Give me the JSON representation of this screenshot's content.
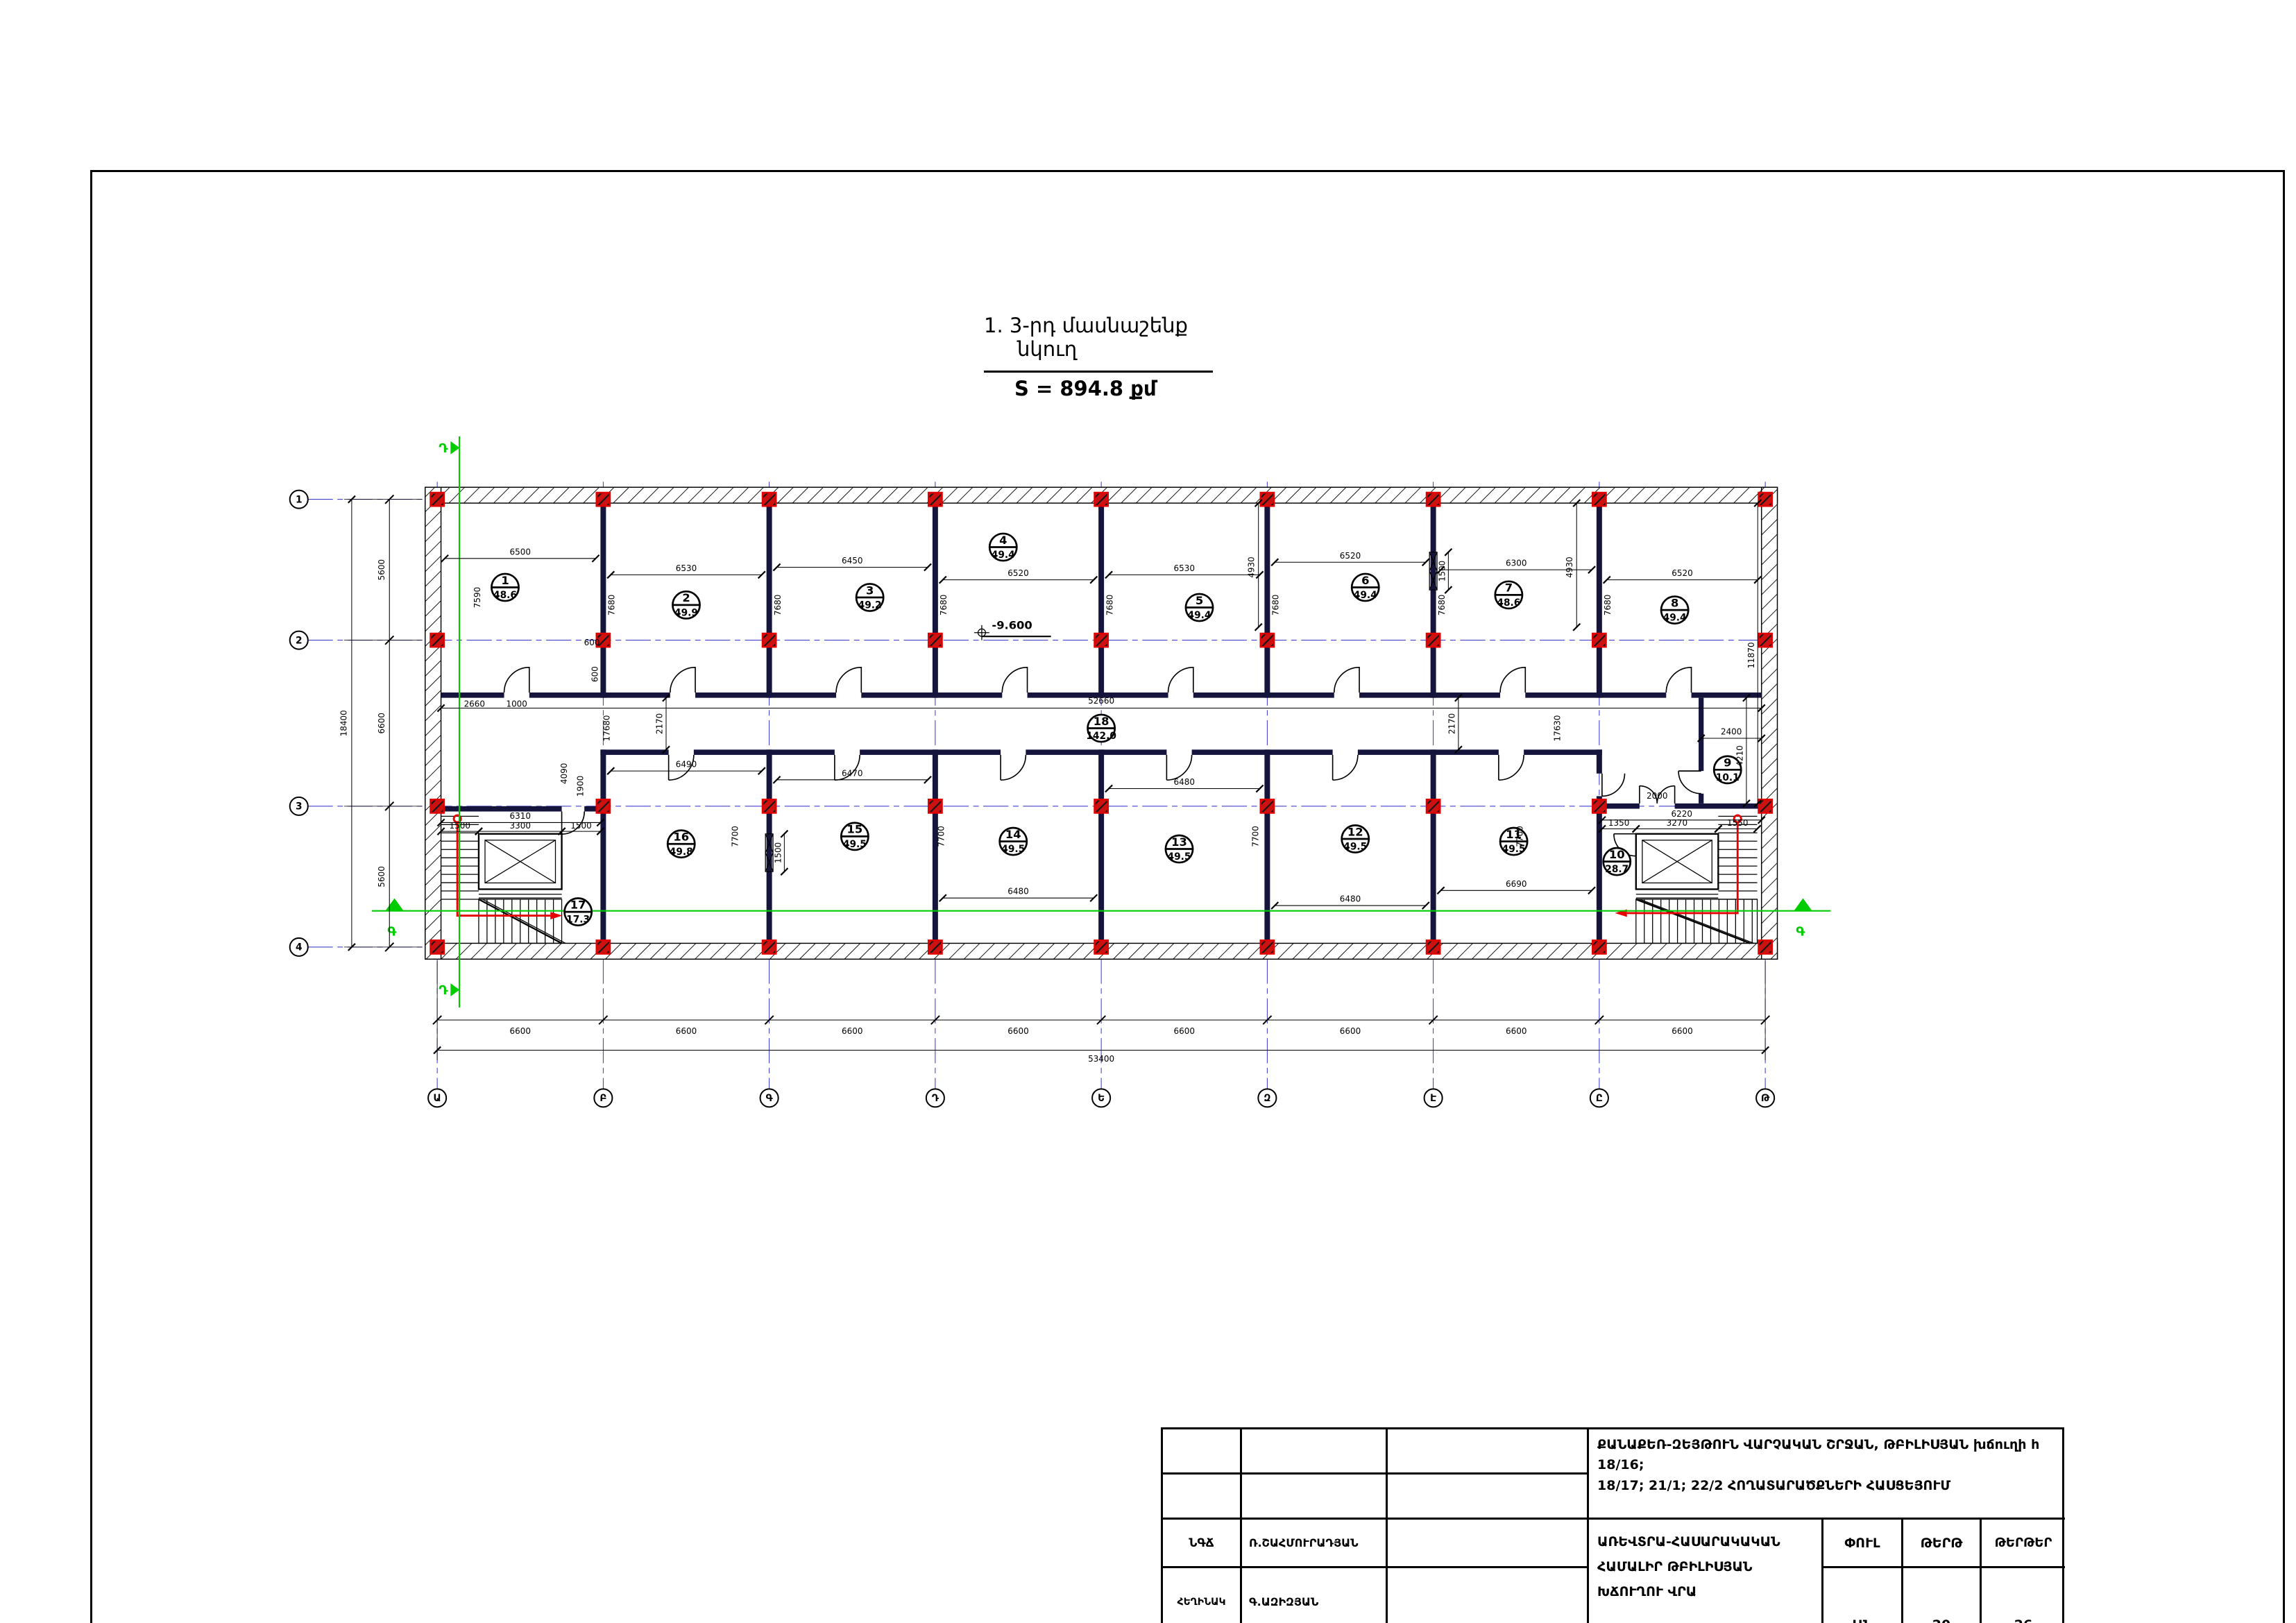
{
  "page": {
    "title_line1": "1. 3-րդ մասնաշենք",
    "title_line2": "նկուղ",
    "area_total": "S = 894.8 քմ"
  },
  "plan": {
    "level_mark": "-9.600",
    "axes_cols": [
      "Ա",
      "Բ",
      "Գ",
      "Դ",
      "Ե",
      "Զ",
      "Է",
      "Ը",
      "Թ"
    ],
    "axes_rows": [
      "1",
      "2",
      "3",
      "4"
    ],
    "bottom_dims": {
      "bays": [
        "6600",
        "6600",
        "6600",
        "6600",
        "6600",
        "6600",
        "6600",
        "6600"
      ],
      "total": "53400"
    },
    "left_dims": {
      "segments": [
        "5600",
        "6600",
        "5600"
      ],
      "total": "18400"
    },
    "rooms_top": [
      {
        "no": "1",
        "area": "48.6",
        "w": "6500",
        "h": "7590"
      },
      {
        "no": "2",
        "area": "49.9",
        "w": "6530",
        "h": "7680"
      },
      {
        "no": "3",
        "area": "49.2",
        "w": "6450",
        "h": "7680"
      },
      {
        "no": "4",
        "area": "49.4",
        "w": "6520",
        "h": "7680"
      },
      {
        "no": "5",
        "area": "49.4",
        "w": "6530",
        "h": "7680"
      },
      {
        "no": "6",
        "area": "49.4",
        "w": "6520",
        "h": "7680"
      },
      {
        "no": "7",
        "area": "48.6",
        "w": "6300",
        "h": "7680"
      },
      {
        "no": "8",
        "area": "49.4",
        "w": "6520",
        "h": "7680"
      }
    ],
    "rooms_bottom": [
      {
        "no": "16",
        "area": "49.8",
        "w": "6490",
        "h": "7700"
      },
      {
        "no": "15",
        "area": "49.5",
        "w": "6470",
        "h": "7700"
      },
      {
        "no": "14",
        "area": "49.5",
        "w": "6480",
        "h": "7700"
      },
      {
        "no": "13",
        "area": "49.5",
        "w": "6480",
        "h": "7700"
      },
      {
        "no": "12",
        "area": "49.5",
        "w": "6480",
        "h": "7700"
      },
      {
        "no": "11",
        "area": "49.5",
        "w": "6690",
        "h": "7700"
      }
    ],
    "corridor": {
      "no": "18",
      "area": "142.0",
      "length": "52660",
      "h_left": "17680",
      "w_left": "2170",
      "h_right": "17630",
      "w_right": "2170"
    },
    "room9": {
      "no": "9",
      "area": "10.1",
      "w": "2400",
      "h": "4210"
    },
    "stair_left": {
      "no": "17",
      "area": "17.3",
      "total": "6310",
      "p1": "1500",
      "p2": "3300",
      "p3": "1500"
    },
    "stair_right": {
      "no": "10",
      "area": "28.7",
      "total": "6220",
      "p1": "1350",
      "p2": "3270",
      "p3": "1550"
    },
    "dims": {
      "right": "11870",
      "n4930": "4930",
      "n4090": "4090",
      "n1900": "1900",
      "n1500": "1500",
      "n2660": "2660",
      "n1000": "1000",
      "n600": "600",
      "n7700": "7700",
      "n2000": "2000"
    },
    "sections": {
      "h": "Գ",
      "v": "Դ"
    }
  },
  "titleblock": {
    "project_line1": "ՔԱՆԱՔԵՌ-ԶԵՅԹՈՒՆ ՎԱՐՉԱԿԱՆ ՇՐՋԱՆ, ԹԲԻԼԻՍՅԱՆ խճուղի հ 18/16;",
    "project_line2": "18/17; 21/1; 22/2 ՀՈՂԱՏԱՐԱԾՔՆԵՐԻ ՀԱՍՑԵՅՈՒՄ",
    "role1": "ՆԳՃ",
    "name1": "Ռ.ՇԱՀՄՈՒՐԱԴՅԱՆ",
    "role2": "ՀԵՂԻՆԱԿ",
    "name2": "Գ.ԱԶԻԶՅԱՆ",
    "object_line": "ԱՌԵՎՏՐԱ-ՀԱՍԱՐԱԿԱԿԱՆ ՀԱՄԱԼԻՐ ԹԲԻԼԻՍՅԱՆ ԽՃՈՒՂՈՒ ՎՐԱ",
    "col_stage": "ՓՈՒԼ",
    "col_sheet": "ԹԵՐԹ",
    "col_sheets": "ԹԵՐԹԵՐ",
    "val_stage": "ԱՆ",
    "val_sheet": "20",
    "val_sheets": "26"
  }
}
